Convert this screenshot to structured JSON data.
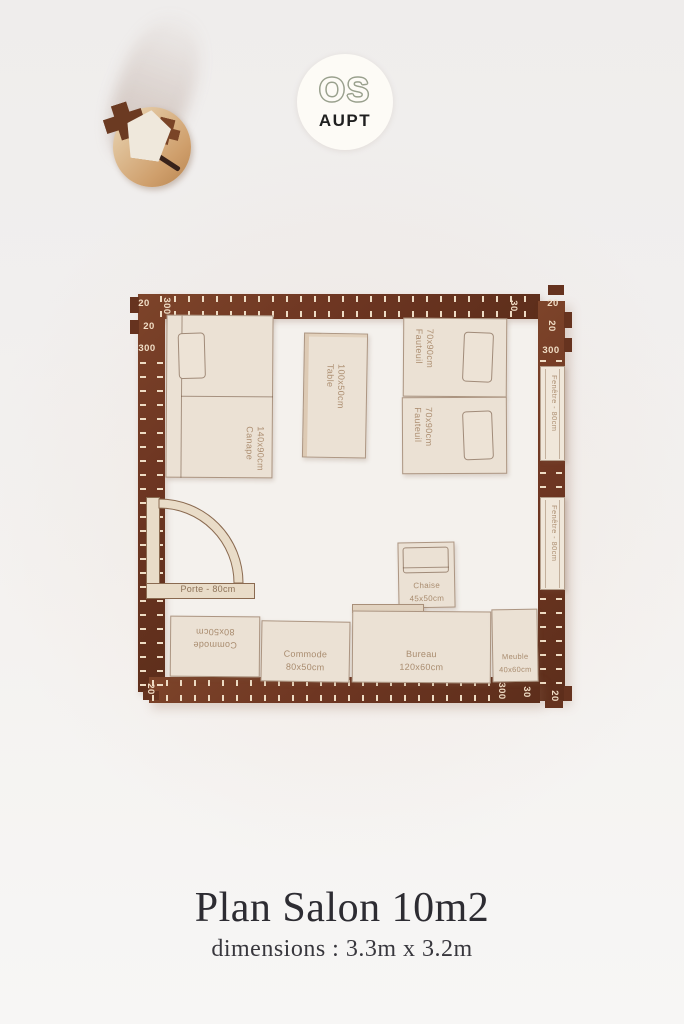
{
  "image_type": "product-photo of laser-cut wooden floor-plan kit",
  "background_color": "#f1efee",
  "logo": {
    "line1": "OS",
    "line2": "AUPT",
    "circle_color": "#fdfbf6",
    "outline_color": "#99a08d",
    "text_color": "#1f1f1f"
  },
  "footer": {
    "title": "Plan Salon 10m2",
    "subtitle": "dimensions : 3.3m x 3.2m"
  },
  "plan": {
    "wall_color": "#6e3622",
    "piece_color": "#ebe1d4",
    "engraving_color": "#ad8f72",
    "tick_color": "#eedcc4",
    "ruler_labels": {
      "top_left_corner": "20",
      "left_top_a": "20",
      "left_top_b": "300",
      "top_start": "300",
      "top_end": "30",
      "top_right_corner": "20",
      "right_top_a": "20",
      "right_top_b": "300",
      "left_bottom": "20",
      "bottom_end": "300",
      "bottom_corner_a": "30",
      "bottom_corner_b": "20"
    },
    "furniture": {
      "canape": {
        "label": "Canape",
        "size": "140x90cm"
      },
      "table": {
        "label": "Table",
        "size": "100x50cm"
      },
      "fauteuil_1": {
        "label": "Fauteuil",
        "size": "70x90cm"
      },
      "fauteuil_2": {
        "label": "Fauteuil",
        "size": "70x90cm"
      },
      "chaise": {
        "label": "Chaise",
        "size": "45x50cm"
      },
      "commode_1": {
        "label": "Commode",
        "size": "80x50cm"
      },
      "commode_2": {
        "label": "Commode",
        "size": "80x50cm"
      },
      "bureau": {
        "label": "Bureau",
        "size": "120x60cm"
      },
      "meuble": {
        "label": "Meuble",
        "size": "40x60cm"
      },
      "porte": {
        "label": "Porte - 80cm"
      },
      "fenetre_1": {
        "label": "Fenêtre - 80cm"
      },
      "fenetre_2": {
        "label": "Fenêtre - 80cm"
      }
    }
  }
}
